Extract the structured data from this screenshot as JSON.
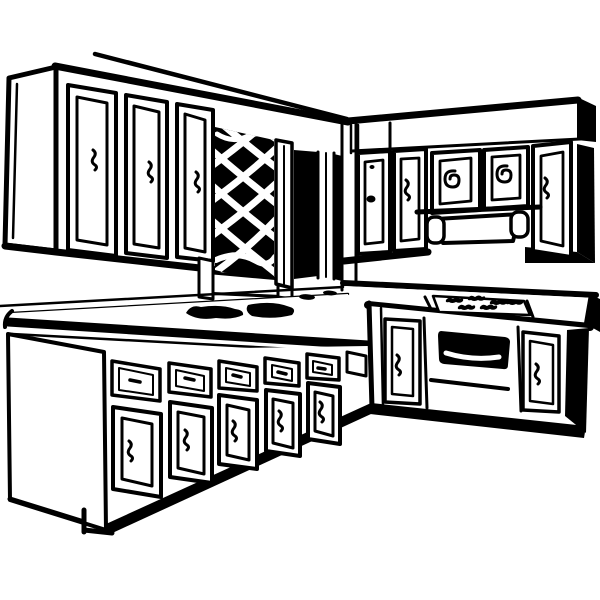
{
  "image": {
    "type": "clipart-line-drawing",
    "subject": "Retro kitchen interior clip art",
    "alt_text": "Black and white line drawing of a kitchen corner: upper wall cabinets with paneled doors and a diamond lattice niche, a range hood under small cabinet doors, and an L-shaped base cabinet run with drawers, cupboard doors, a sink silhouette on the counter, cooktop burners and an oven with a dark window.",
    "style": {
      "line_color": "#000000",
      "background_color": "#ffffff"
    },
    "elements": [
      {
        "name": "upper-cabinets-left",
        "label": "Left run of wall cabinets, three paneled doors with squiggle handles"
      },
      {
        "name": "lattice-niche",
        "label": "Dark niche with white diamond lattice panel and frame legs"
      },
      {
        "name": "doorway-opening",
        "label": "Dark vertical opening beside the lattice panel"
      },
      {
        "name": "upper-cabinets-right",
        "label": "Right run of wall cabinets under a soffit, doors with dot, squiggle and spiral handles"
      },
      {
        "name": "range-hood",
        "label": "Trapezoidal range hood with rounded end feet"
      },
      {
        "name": "countertop-left",
        "label": "Left countertop with rounded front corner"
      },
      {
        "name": "sink-silhouette",
        "label": "Black sink and faucet silhouette on the counter"
      },
      {
        "name": "base-cabinets-left",
        "label": "Five base cabinet sections, each a drawer over a cupboard door"
      },
      {
        "name": "base-cabinets-right",
        "label": "Right base run with corner post, doors and oven"
      },
      {
        "name": "cooktop-burners",
        "label": "Squiggly burner marks on the cooktop"
      },
      {
        "name": "oven",
        "label": "Oven with black window, white glare and long handle bar"
      },
      {
        "name": "toe-kick",
        "label": "Toe-kick notch at the lower left cabinet base"
      }
    ]
  }
}
